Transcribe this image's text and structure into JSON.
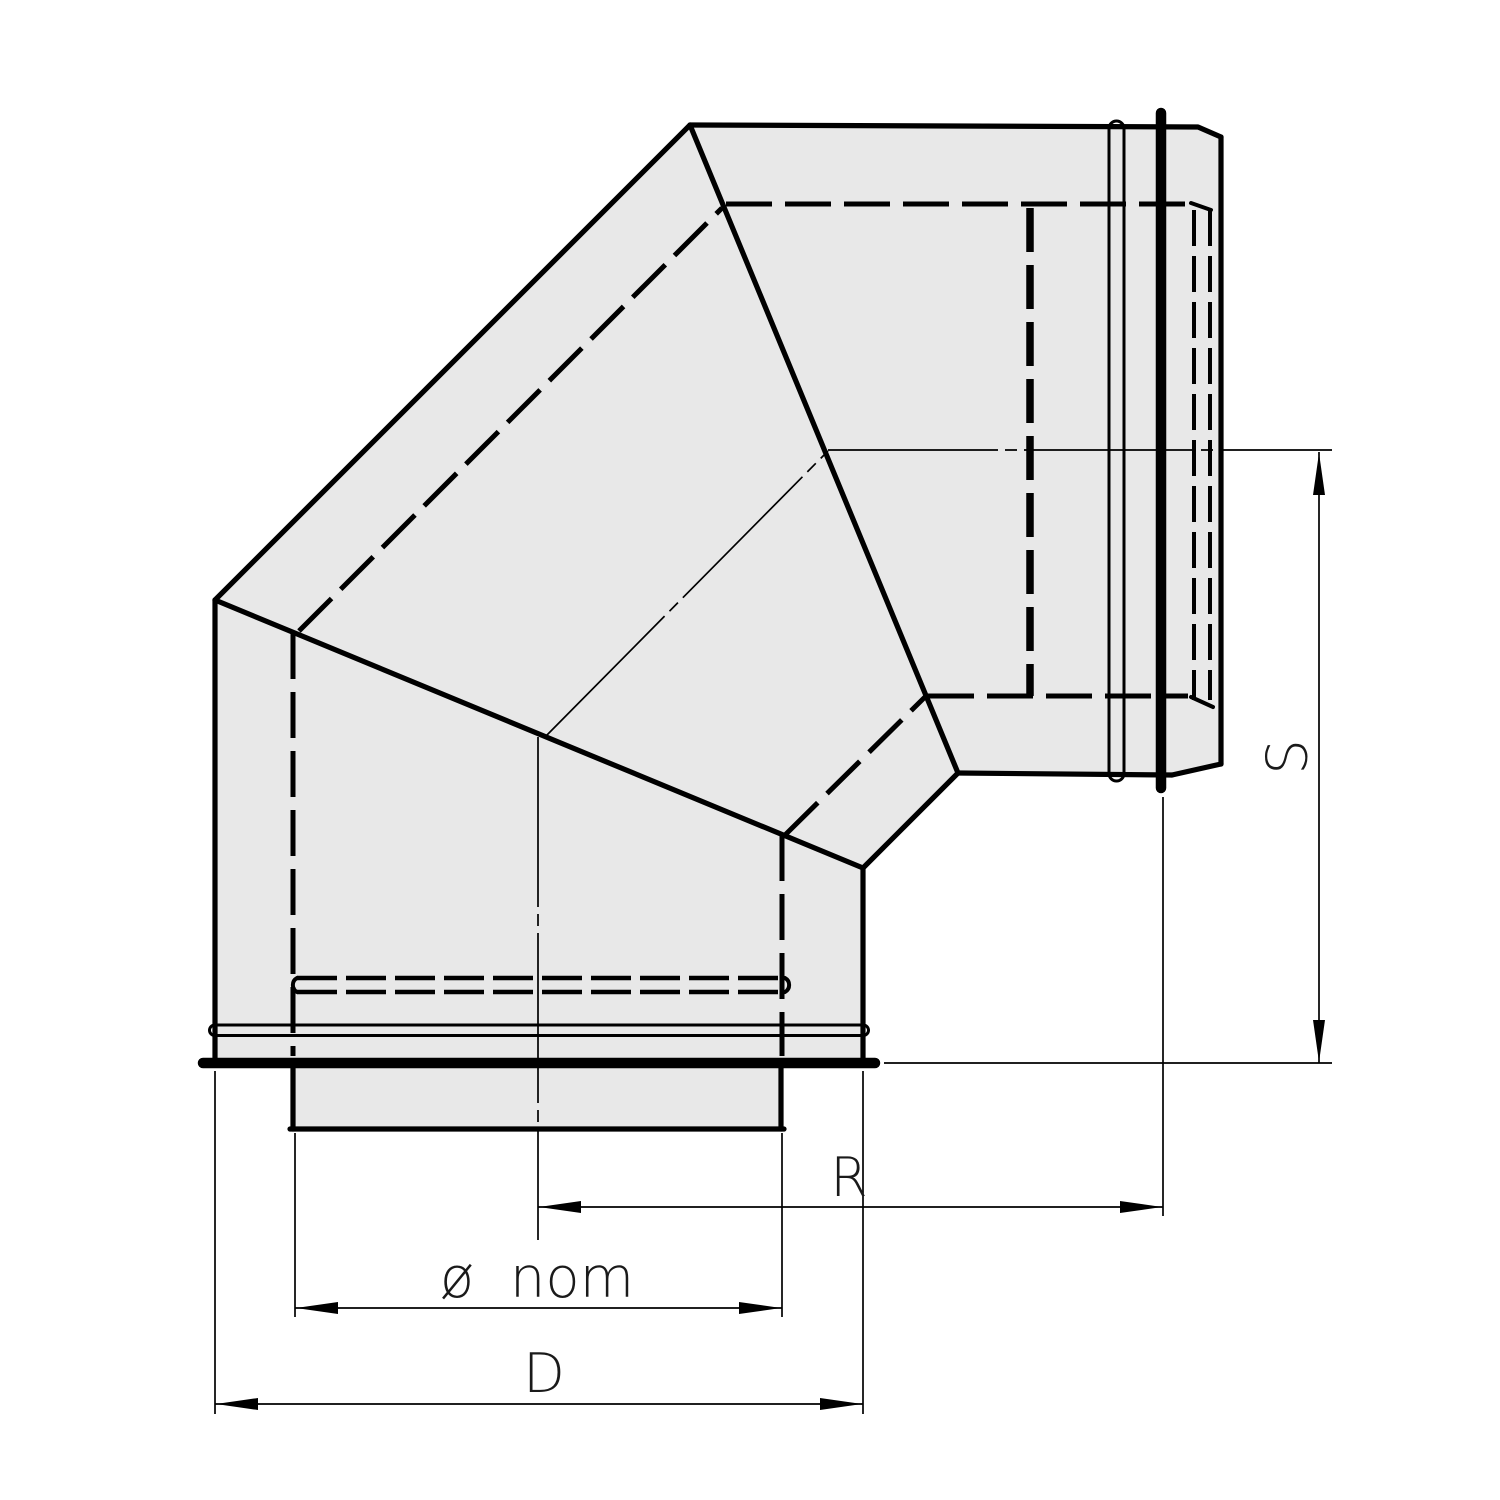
{
  "drawing": {
    "kind": "technical line drawing of a 90-degree mitred pipe elbow fitting",
    "labels": {
      "s": "S",
      "r": "R",
      "diameter_nominal": "ø nom",
      "d": "D"
    }
  },
  "colors": {
    "background": "#ffffff",
    "line": "#000000",
    "body_fill": "#e8e8e8",
    "text": "#1a1a1a"
  }
}
